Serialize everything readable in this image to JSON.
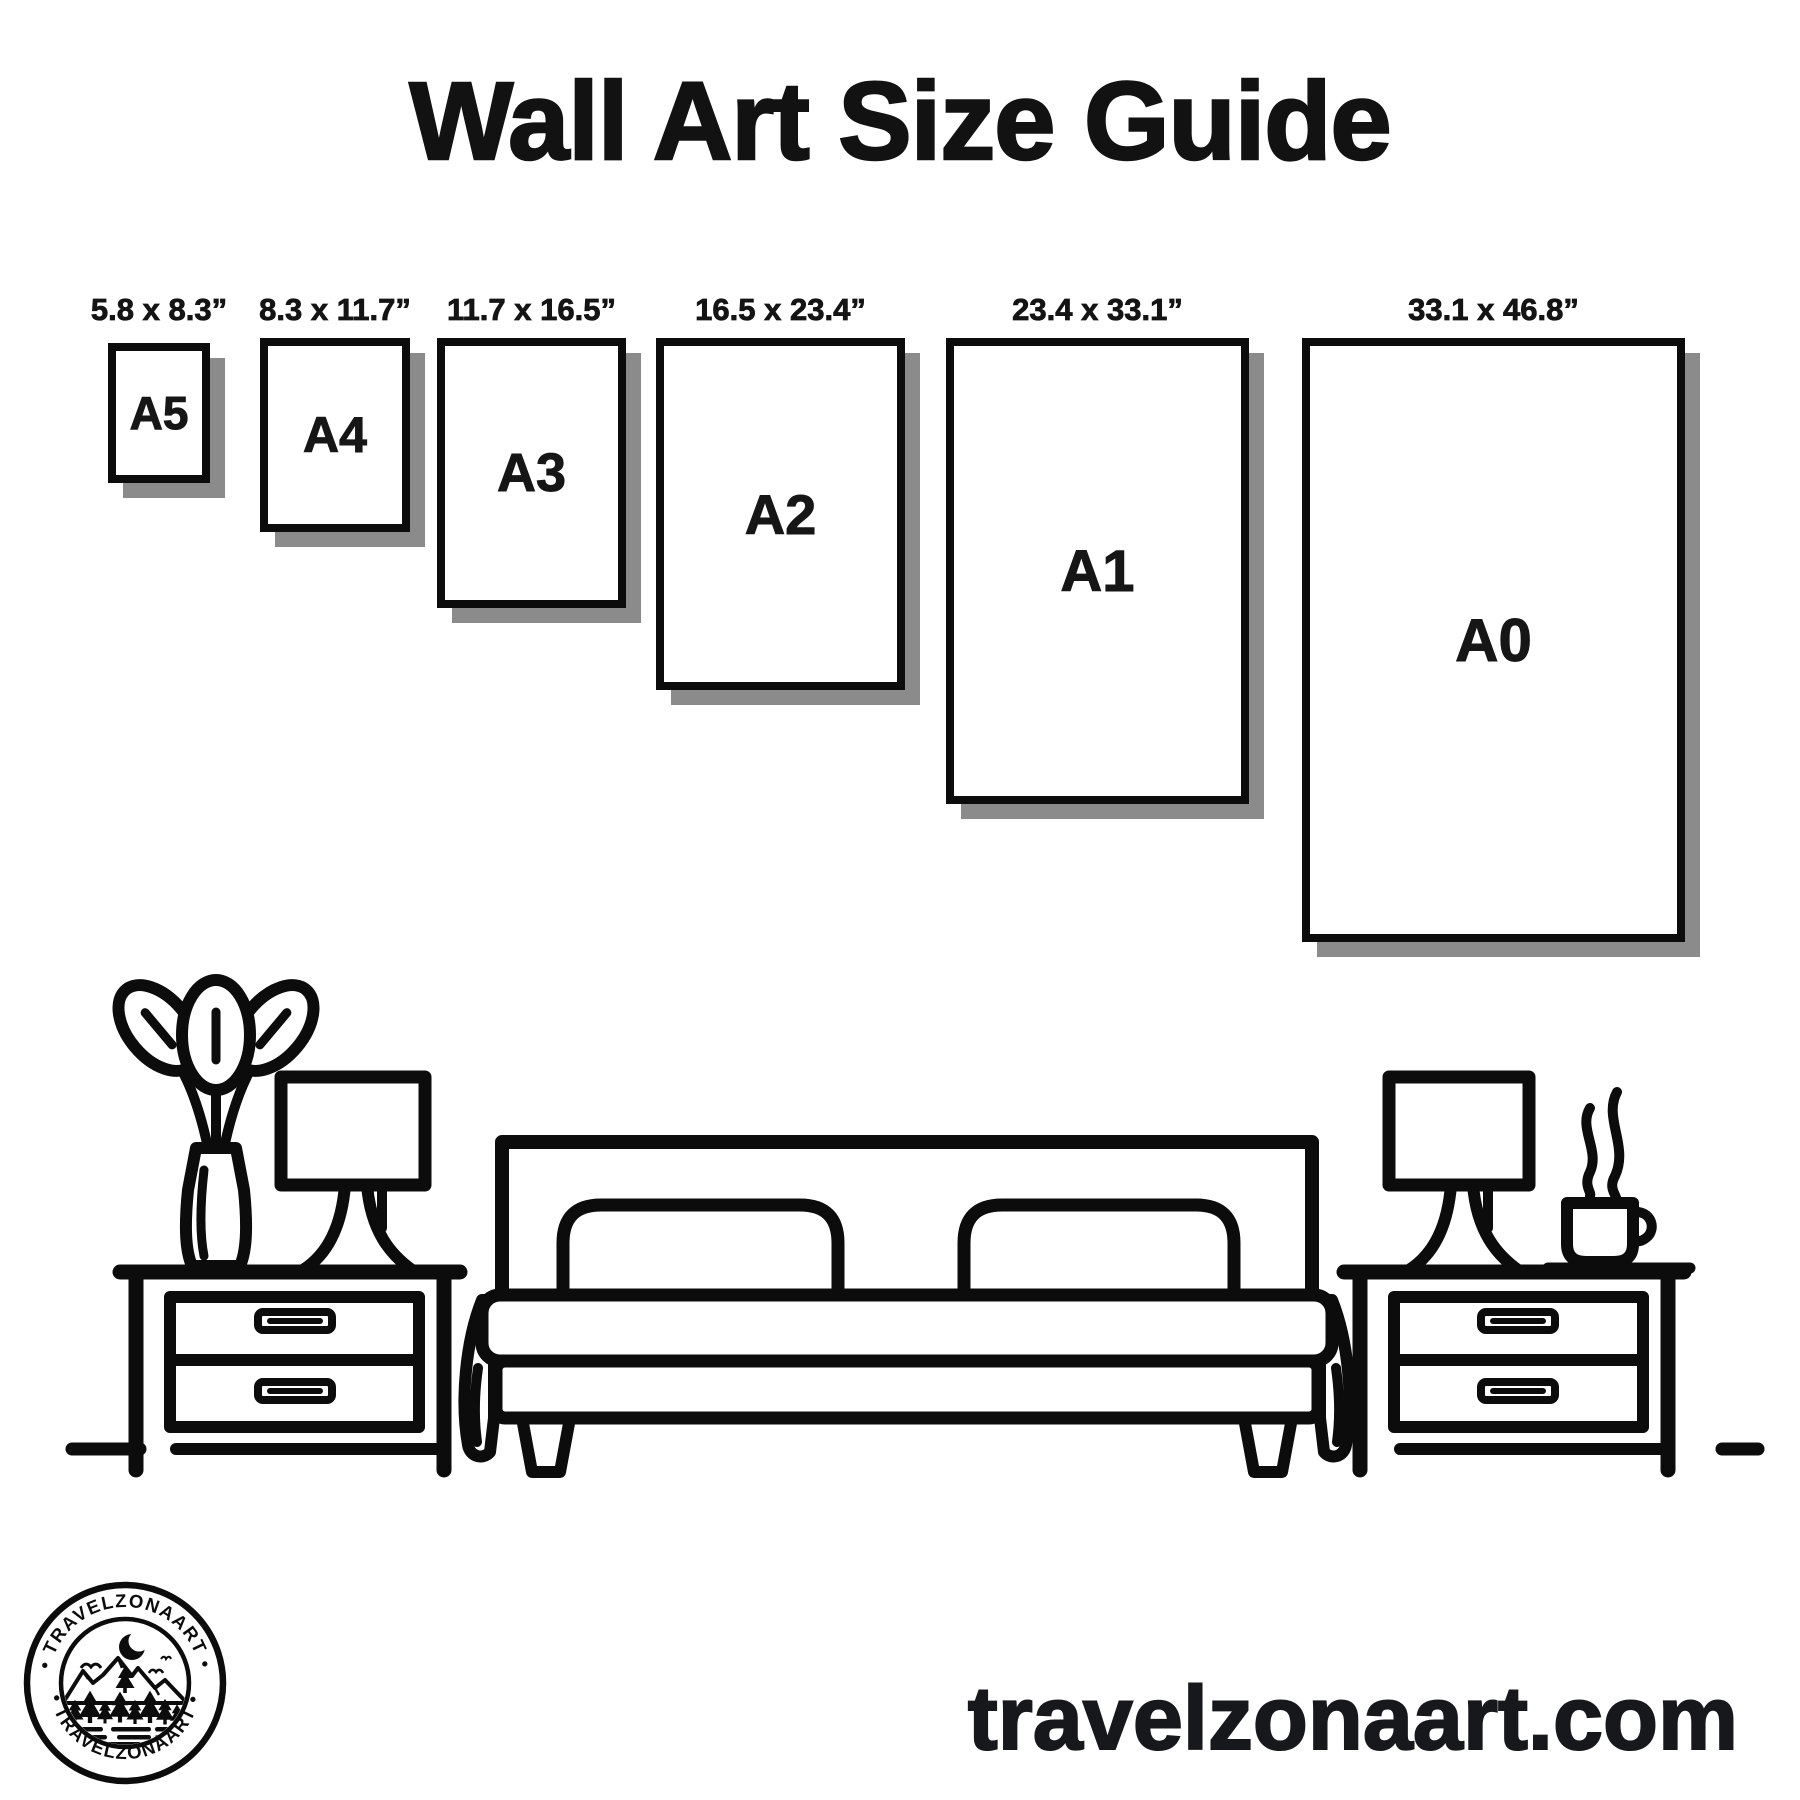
{
  "page": {
    "title": "Wall Art Size Guide",
    "website": "travelzonaart.com"
  },
  "papers": [
    {
      "name": "A5",
      "dims": "5.8 x 8.3”"
    },
    {
      "name": "A4",
      "dims": "8.3 x 11.7”"
    },
    {
      "name": "A3",
      "dims": "11.7 x 16.5”"
    },
    {
      "name": "A2",
      "dims": "16.5 x 23.4”"
    },
    {
      "name": "A1",
      "dims": "23.4 x 33.1”"
    },
    {
      "name": "A0",
      "dims": "33.1 x 46.8”"
    }
  ],
  "logo": {
    "text_top": "• TRAVELZONAART •",
    "text_bottom": "• TRAVELZONAART •"
  },
  "scene": {
    "items": [
      "potted-plant-icon",
      "table-lamp-icon",
      "nightstand-icon",
      "double-bed-icon",
      "pillow-icon",
      "blanket-drape-icon",
      "coffee-cup-icon",
      "steam-icon",
      "floor-line"
    ]
  },
  "colors": {
    "ink": "#0c0c0c",
    "shadow": "#8b8b8b",
    "background": "#ffffff"
  }
}
